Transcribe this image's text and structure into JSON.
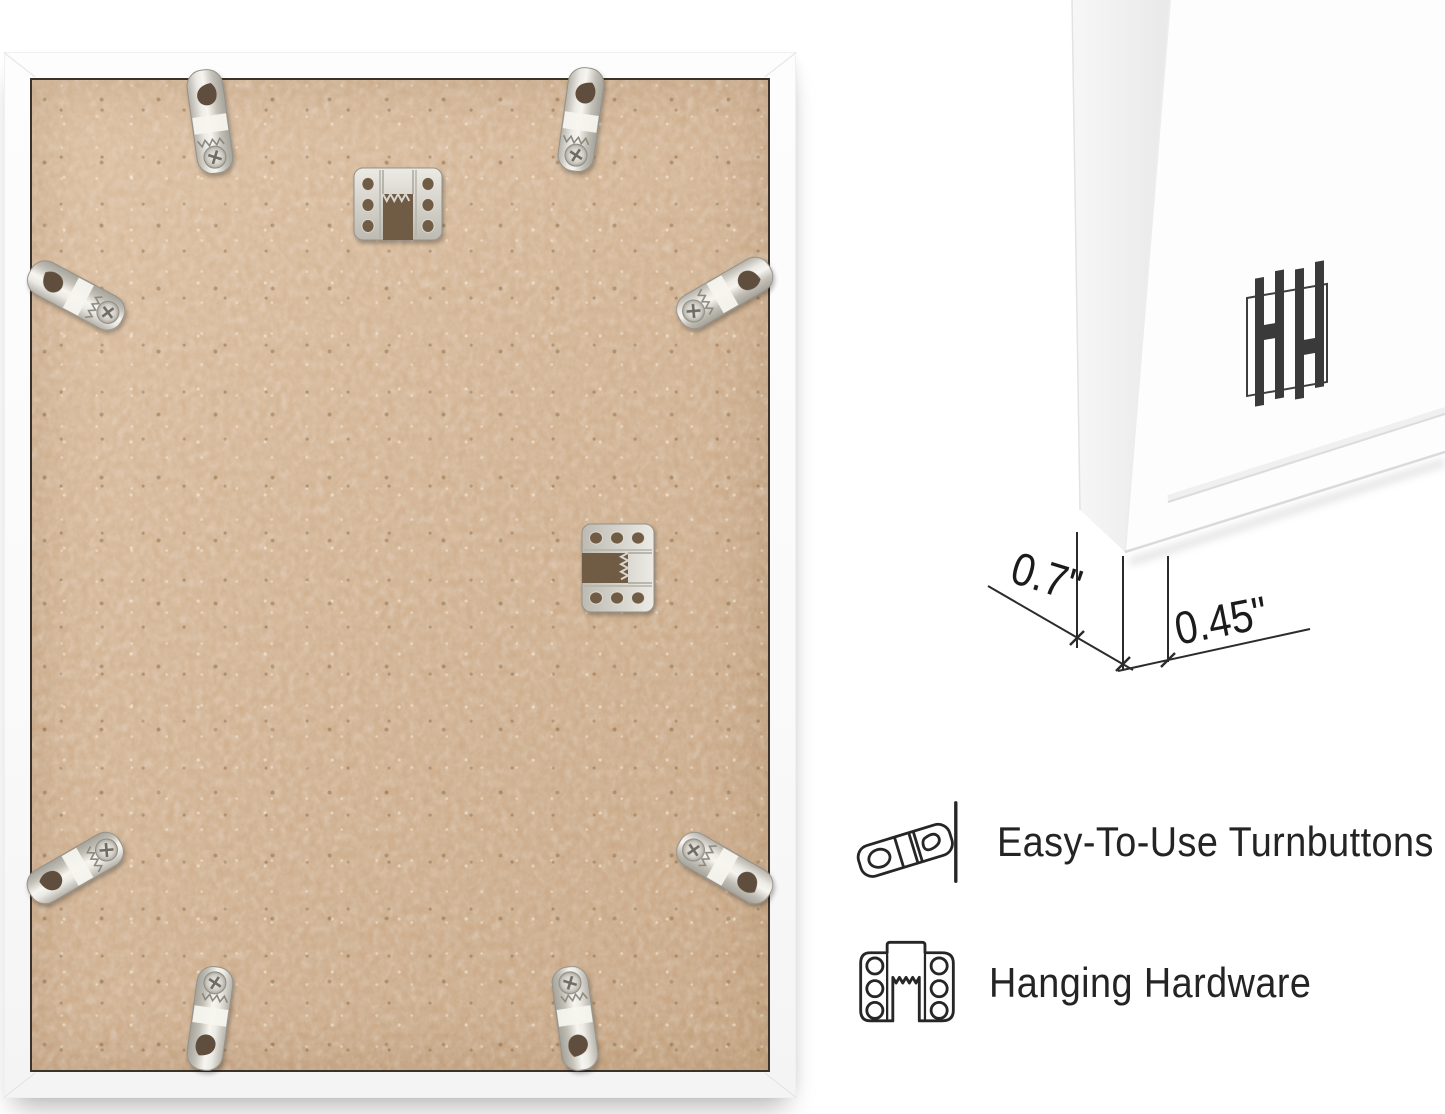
{
  "page": {
    "background_color": "#ffffff"
  },
  "photo": {
    "subject": "picture-frame-back",
    "frame_color": "#fcfcfc",
    "backing_color": "#cfae8c",
    "turnbutton_count": 8,
    "sawtooth_hanger_count": 2
  },
  "corner_detail": {
    "subject": "frame-corner-front-view",
    "logo_icon": "hh-monogram-logo",
    "dimensions": [
      {
        "label": "0.7\""
      },
      {
        "label": "0.45\""
      }
    ]
  },
  "features": [
    {
      "icon": "turnbutton-icon",
      "label": "Easy-To-Use Turnbuttons"
    },
    {
      "icon": "hanging-hardware-icon",
      "label": "Hanging Hardware"
    }
  ],
  "colors": {
    "metal": "#cfcdc5",
    "outline": "#262626",
    "text": "#242424",
    "backing_edge": "#3a332a"
  }
}
